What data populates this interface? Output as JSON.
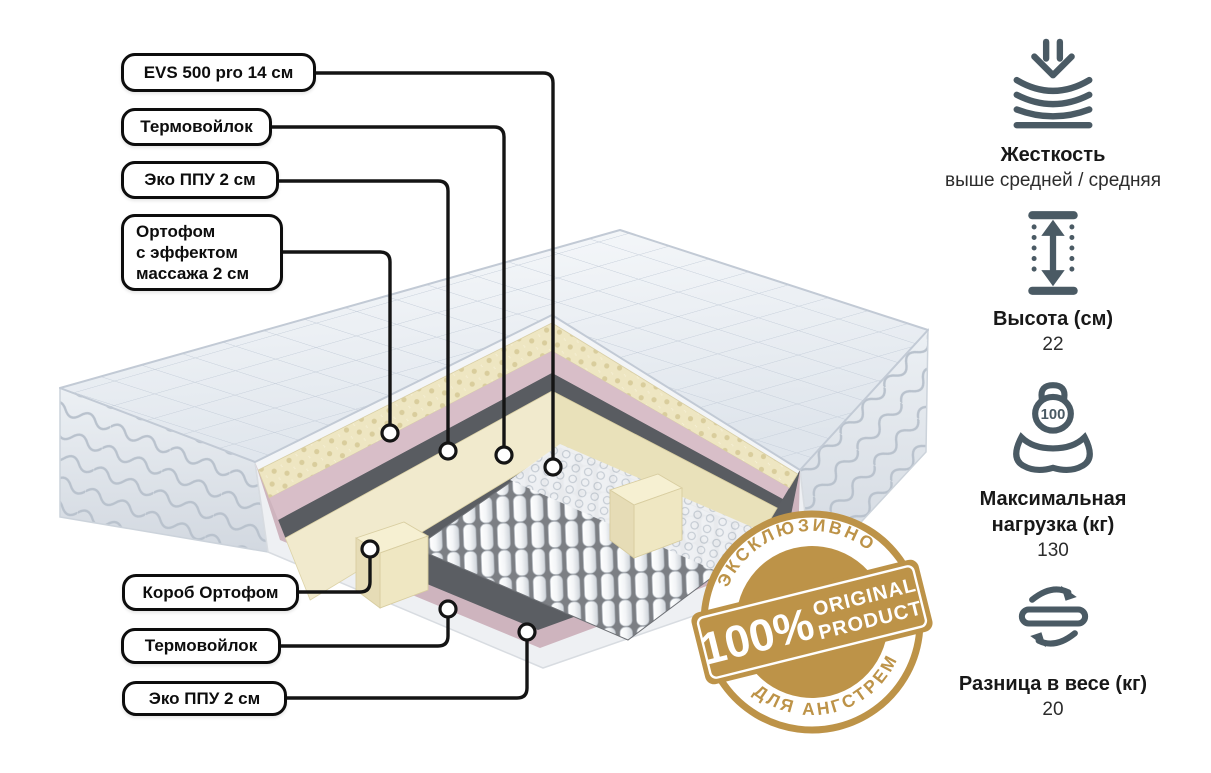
{
  "callouts": {
    "evs": "EVS 500 pro 14 см",
    "thermo_top": "Термовойлок",
    "eko_top": "Эко ППУ 2 см",
    "orto_lines": [
      "Ортофом",
      "с эффектом",
      "массажа 2 см"
    ],
    "korob": "Короб Ортофом",
    "thermo_bottom": "Термовойлок",
    "eko_bottom": "Эко ППУ 2 см"
  },
  "specs": [
    {
      "icon": "firmness-icon",
      "title": "Жесткость",
      "value": "выше средней / средняя"
    },
    {
      "icon": "height-icon",
      "title": "Высота (см)",
      "value": "22"
    },
    {
      "icon": "max-load-icon",
      "title": "Максимальная нагрузка (кг)",
      "value": "130",
      "icon_label": "100"
    },
    {
      "icon": "weight-diff-icon",
      "title": "Разница в весе (кг)",
      "value": "20"
    }
  ],
  "badge": {
    "top_text": "ЭКСКЛЮЗИВНО",
    "percent": "100%",
    "line1": "ORIGINAL",
    "line2": "PRODUCT",
    "bottom_text": "ДЛЯ АНГСТРЕМ"
  },
  "colors": {
    "badge_gold": "#bd9348",
    "icon_slate": "#4a5a64",
    "foam_cream": "#efe7c2",
    "layer_pink": "#d5bbc5",
    "felt_dark": "#5b5e63",
    "line_black": "#141414"
  }
}
